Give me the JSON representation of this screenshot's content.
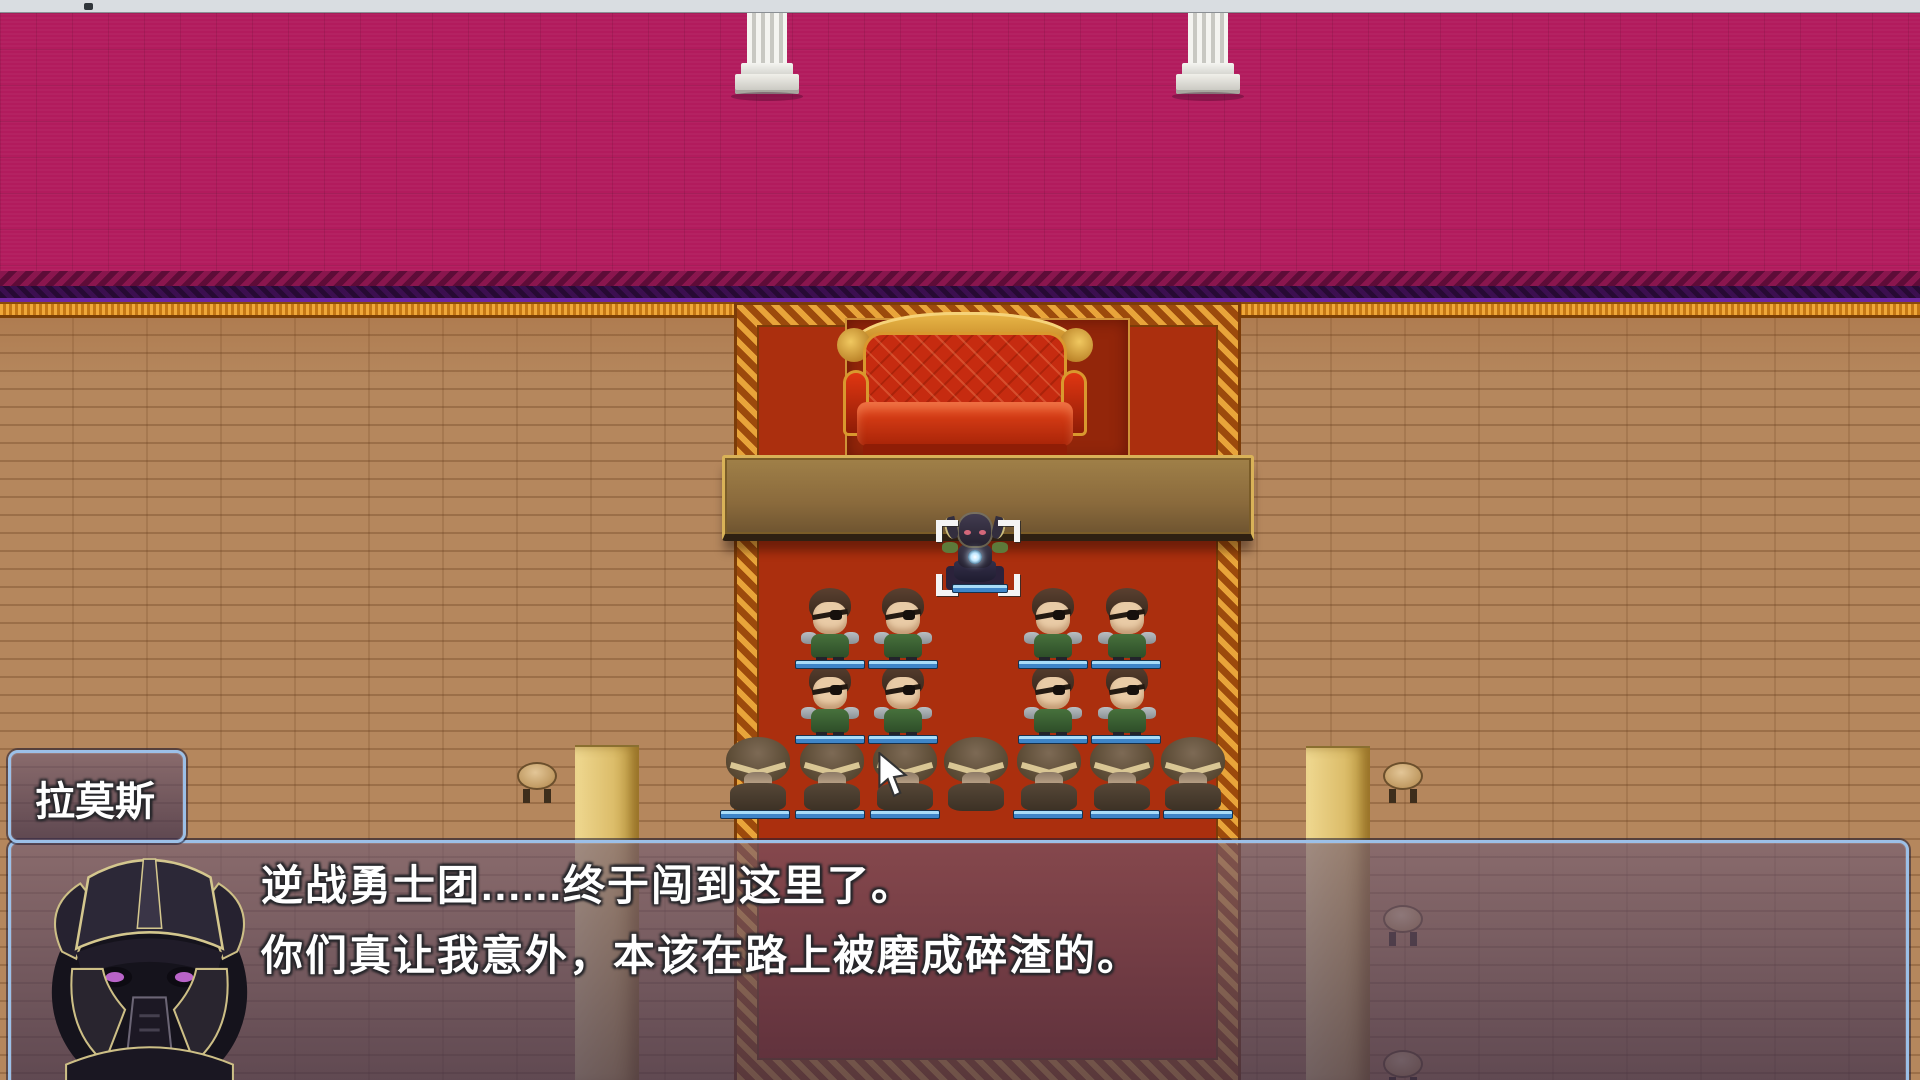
{
  "window": {
    "topbar": "window-edge-bar"
  },
  "name_box": {
    "text": "拉莫斯"
  },
  "dialog": {
    "lines": [
      "逆战勇士团......终于闯到这里了。",
      "你们真让我意外，本该在路上被磨成碎渣的。"
    ],
    "portrait": "dark-armored-knight"
  },
  "colors": {
    "wall": "#b21b5d",
    "wall_band": "#3c0f50",
    "trim_gold": "#e0941f",
    "floor": "#b5875d",
    "carpet_red": "#ab2f0e",
    "carpet_border": "#b4540e",
    "sofa_red": "#c62b10",
    "table_tan": "#8a6a3c",
    "hp_bar_blue": "#3e85c8",
    "window_border_blue": "#9cc0e8",
    "pillar_white": "#e8e8e4"
  },
  "scene": {
    "entities": [
      {
        "t": "wpillar",
        "x": 735,
        "y": 13
      },
      {
        "t": "wpillar",
        "x": 1176,
        "y": 13
      },
      {
        "t": "bracket",
        "x": 936,
        "y": 520
      },
      {
        "t": "boss",
        "x": 940,
        "y": 510
      },
      {
        "t": "soldier",
        "x": 797,
        "y": 588
      },
      {
        "t": "soldier",
        "x": 870,
        "y": 588
      },
      {
        "t": "soldier",
        "x": 1020,
        "y": 588
      },
      {
        "t": "soldier",
        "x": 1094,
        "y": 588
      },
      {
        "t": "soldier",
        "x": 797,
        "y": 663
      },
      {
        "t": "soldier",
        "x": 870,
        "y": 663
      },
      {
        "t": "soldier",
        "x": 1020,
        "y": 663
      },
      {
        "t": "soldier",
        "x": 1094,
        "y": 663
      },
      {
        "t": "hooded",
        "x": 722,
        "y": 737
      },
      {
        "t": "hooded",
        "x": 796,
        "y": 737
      },
      {
        "t": "hooded",
        "x": 869,
        "y": 737
      },
      {
        "t": "hooded",
        "x": 940,
        "y": 737
      },
      {
        "t": "hooded",
        "x": 1013,
        "y": 737
      },
      {
        "t": "hooded",
        "x": 1086,
        "y": 737
      },
      {
        "t": "hooded",
        "x": 1157,
        "y": 737
      },
      {
        "t": "bosshp",
        "x": 952,
        "y": 584
      },
      {
        "t": "hpbar",
        "x": 795,
        "y": 660
      },
      {
        "t": "hpbar",
        "x": 868,
        "y": 660
      },
      {
        "t": "hpbar",
        "x": 1018,
        "y": 660
      },
      {
        "t": "hpbar",
        "x": 1091,
        "y": 660
      },
      {
        "t": "hpbar",
        "x": 795,
        "y": 735
      },
      {
        "t": "hpbar",
        "x": 868,
        "y": 735
      },
      {
        "t": "hpbar",
        "x": 1018,
        "y": 735
      },
      {
        "t": "hpbar",
        "x": 1091,
        "y": 735
      },
      {
        "t": "hpbar",
        "x": 720,
        "y": 810
      },
      {
        "t": "hpbar",
        "x": 795,
        "y": 810
      },
      {
        "t": "hpbar",
        "x": 870,
        "y": 810
      },
      {
        "t": "hpbar",
        "x": 1013,
        "y": 810
      },
      {
        "t": "hpbar",
        "x": 1090,
        "y": 810
      },
      {
        "t": "hpbar",
        "x": 1163,
        "y": 810
      },
      {
        "t": "post",
        "x": 575,
        "y": 745
      },
      {
        "t": "post",
        "x": 1306,
        "y": 746
      },
      {
        "t": "stool",
        "x": 515,
        "y": 760
      },
      {
        "t": "stool",
        "x": 1381,
        "y": 760
      },
      {
        "t": "stool",
        "x": 1381,
        "y": 903
      },
      {
        "t": "stool",
        "x": 1381,
        "y": 1048
      }
    ]
  }
}
